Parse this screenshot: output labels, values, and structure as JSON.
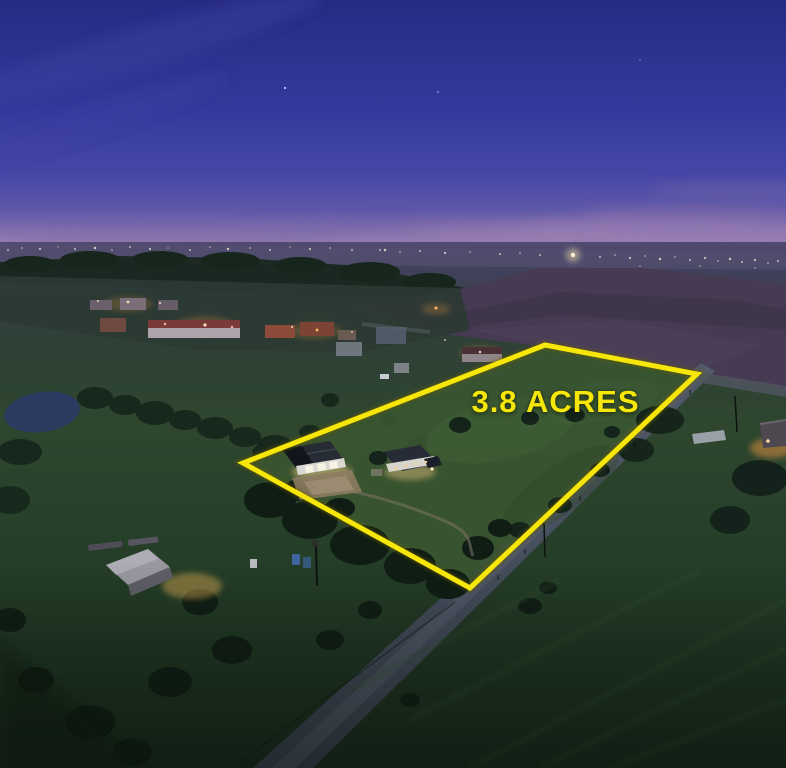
{
  "overlay": {
    "acreage_label": "3.8 ACRES"
  },
  "photo": {
    "description": "Aerial drone photograph at dusk of a rural 3.8 acre property outlined in yellow, containing a metal barn with lit garage doors and a single-story house; a country road runs along the southeast boundary, neighboring farm houses glow to the northwest, a plowed field lies to the northeast, and distant city lights line the horizon under a deep blue and pink twilight sky"
  },
  "colors": {
    "accent_yellow": "#F6E60A",
    "sky_top": "#262B83",
    "sky_mid": "#3D41A0",
    "horizon_pink": "#A283B5",
    "field_green": "#2E4A2E",
    "plowed_field": "#463B52",
    "road_gray": "#4A5160",
    "tree_dark": "#101F15",
    "warm_light": "#FFC35C"
  }
}
